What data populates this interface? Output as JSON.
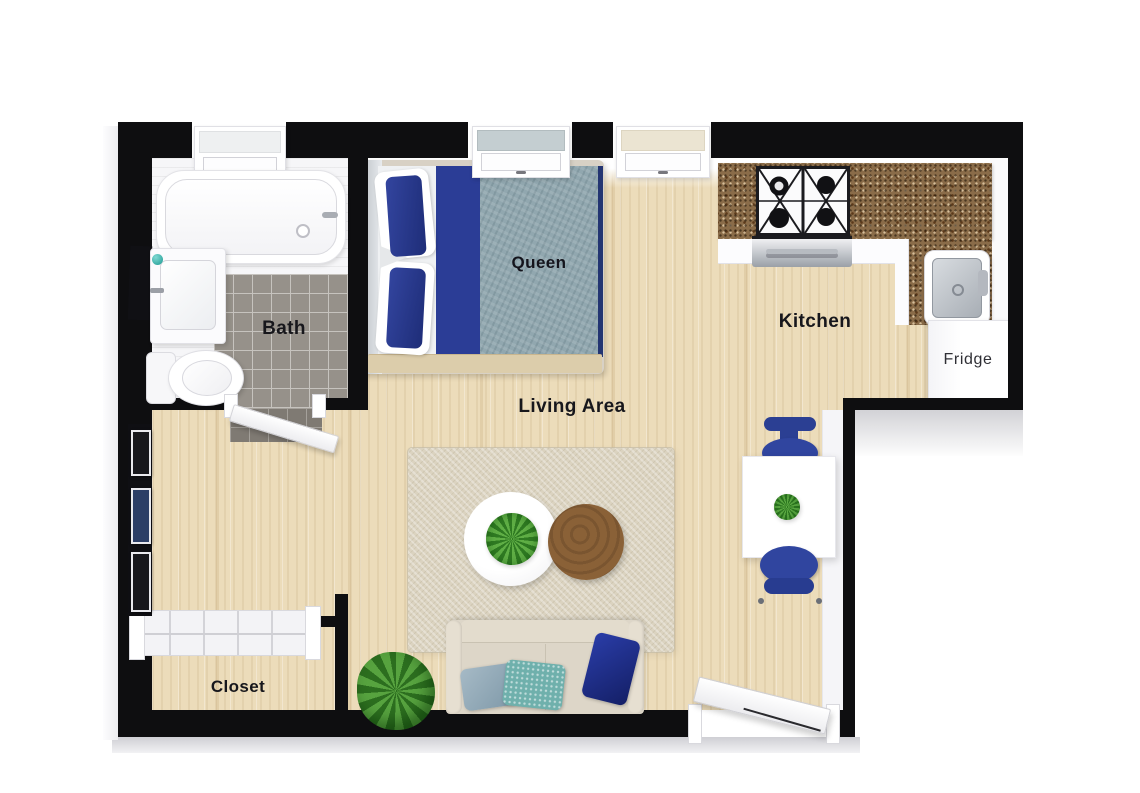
{
  "title": "Studio apartment 3D floor plan",
  "labels": {
    "bath": "Bath",
    "queen": "Queen",
    "kitchen": "Kitchen",
    "living_area": "Living Area",
    "fridge": "Fridge",
    "closet": "Closet"
  },
  "colors": {
    "wall": "#0e0e10",
    "wood_floor": "#ecdcba",
    "bath_tile": "#96918a",
    "area_rug": "#dbd3c0",
    "accent_navy": "#2b3d96",
    "duvet_teal": "#91a7af",
    "counter_granite": "#8a6c49",
    "sofa_linen": "#ddd6c8",
    "coffee_table_wood": "#8a6137",
    "plant_green": "#3e8a2c",
    "dining_chair_blue": "#2e43a0",
    "window_glass_gray": "#c4ced1",
    "window_glass_cream": "#ebe4d2",
    "label_text": "#17171c",
    "exterior": "#ffffff"
  }
}
